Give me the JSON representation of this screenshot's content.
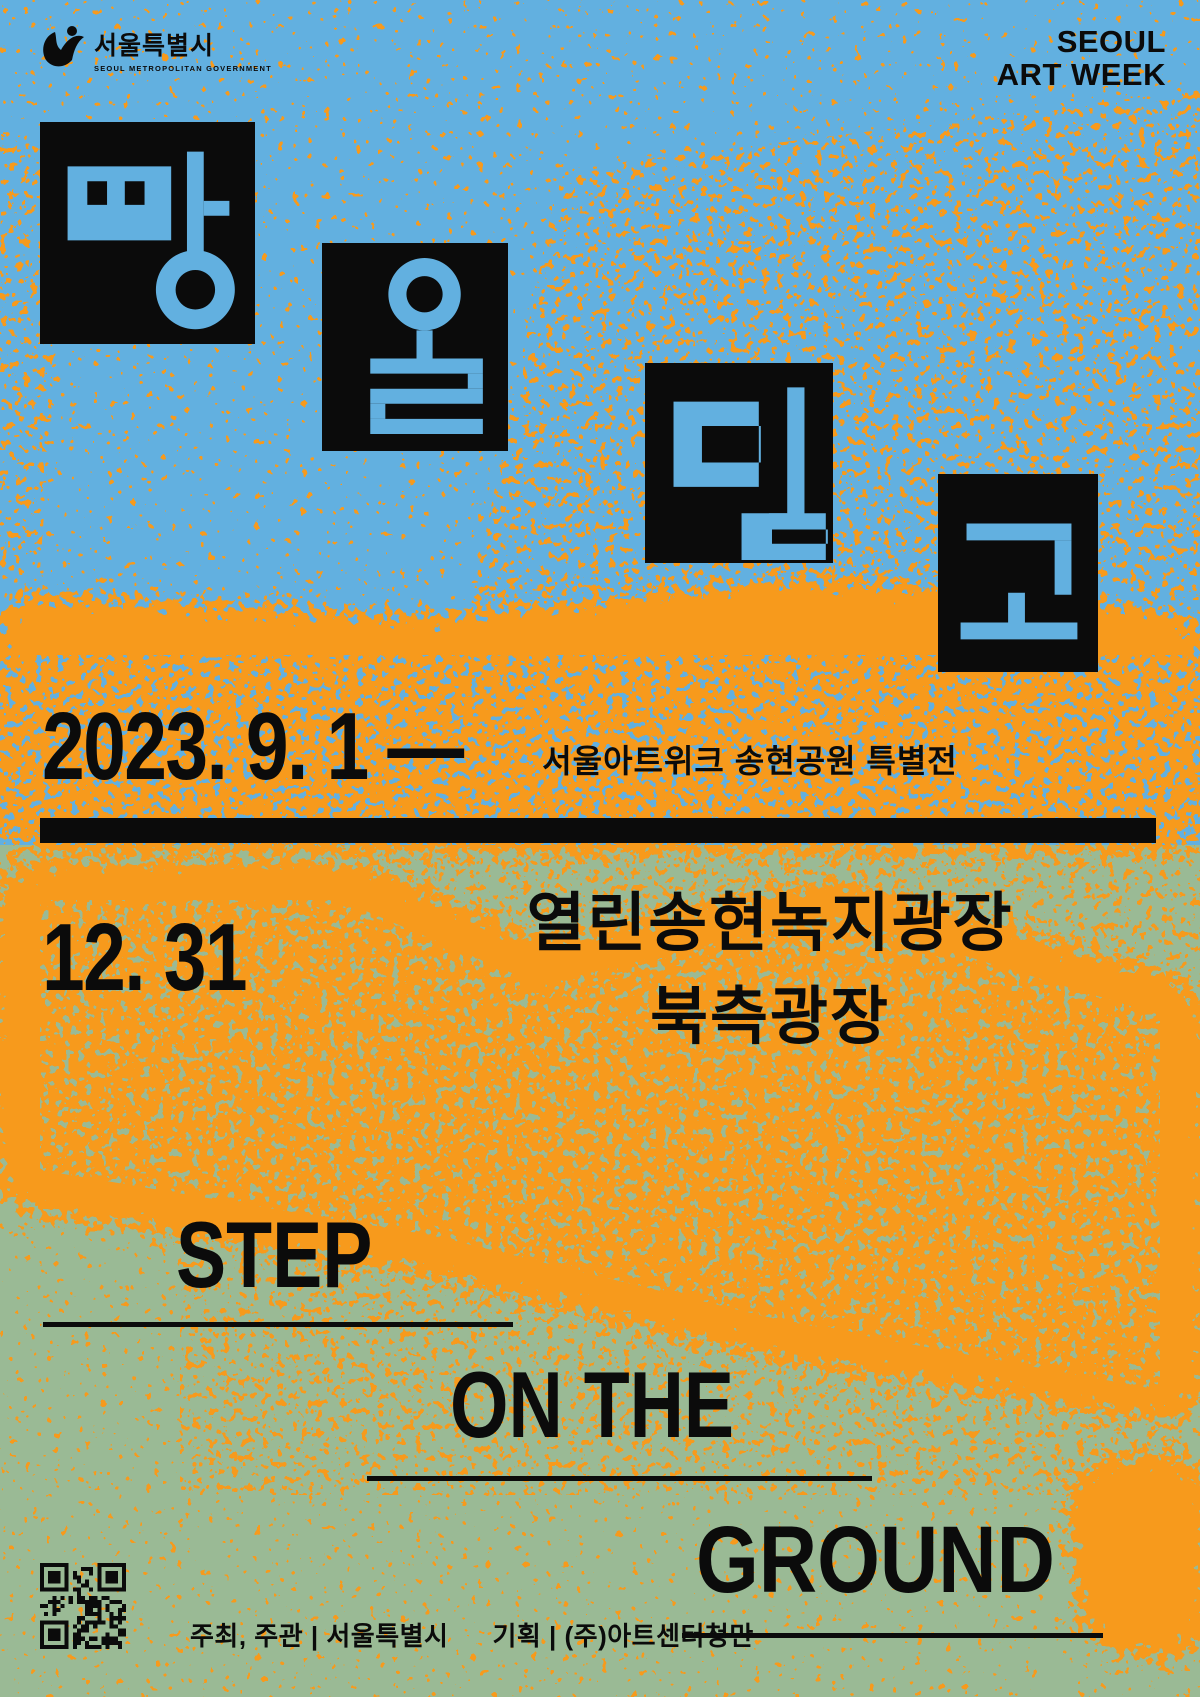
{
  "poster": {
    "colors": {
      "blue": "#62b0e0",
      "orange": "#f79a1d",
      "green": "#9aba95",
      "black": "#0b0b0b"
    },
    "header": {
      "logo_korean": "서울특별시",
      "logo_english": "SEOUL METROPOLITAN GOVERNMENT",
      "artweek_line1": "SEOUL",
      "artweek_line2": "ART WEEK"
    },
    "title_tiles": [
      {
        "char": "땅"
      },
      {
        "char": "을"
      },
      {
        "char": "딛"
      },
      {
        "char": "고"
      }
    ],
    "dates": {
      "line1": "2023. 9. 1 —",
      "line2": "12. 31"
    },
    "subtitle": "서울아트위크 송현공원 특별전",
    "venue": {
      "line1": "열린송현녹지광장",
      "line2": "북측광장"
    },
    "title_en": {
      "word1": "STEP",
      "word2": "ON THE",
      "word3": "GROUND"
    },
    "credits": {
      "host": "주최, 주관 | 서울특별시",
      "planning": "기획 | (주)아트센터청만"
    }
  }
}
